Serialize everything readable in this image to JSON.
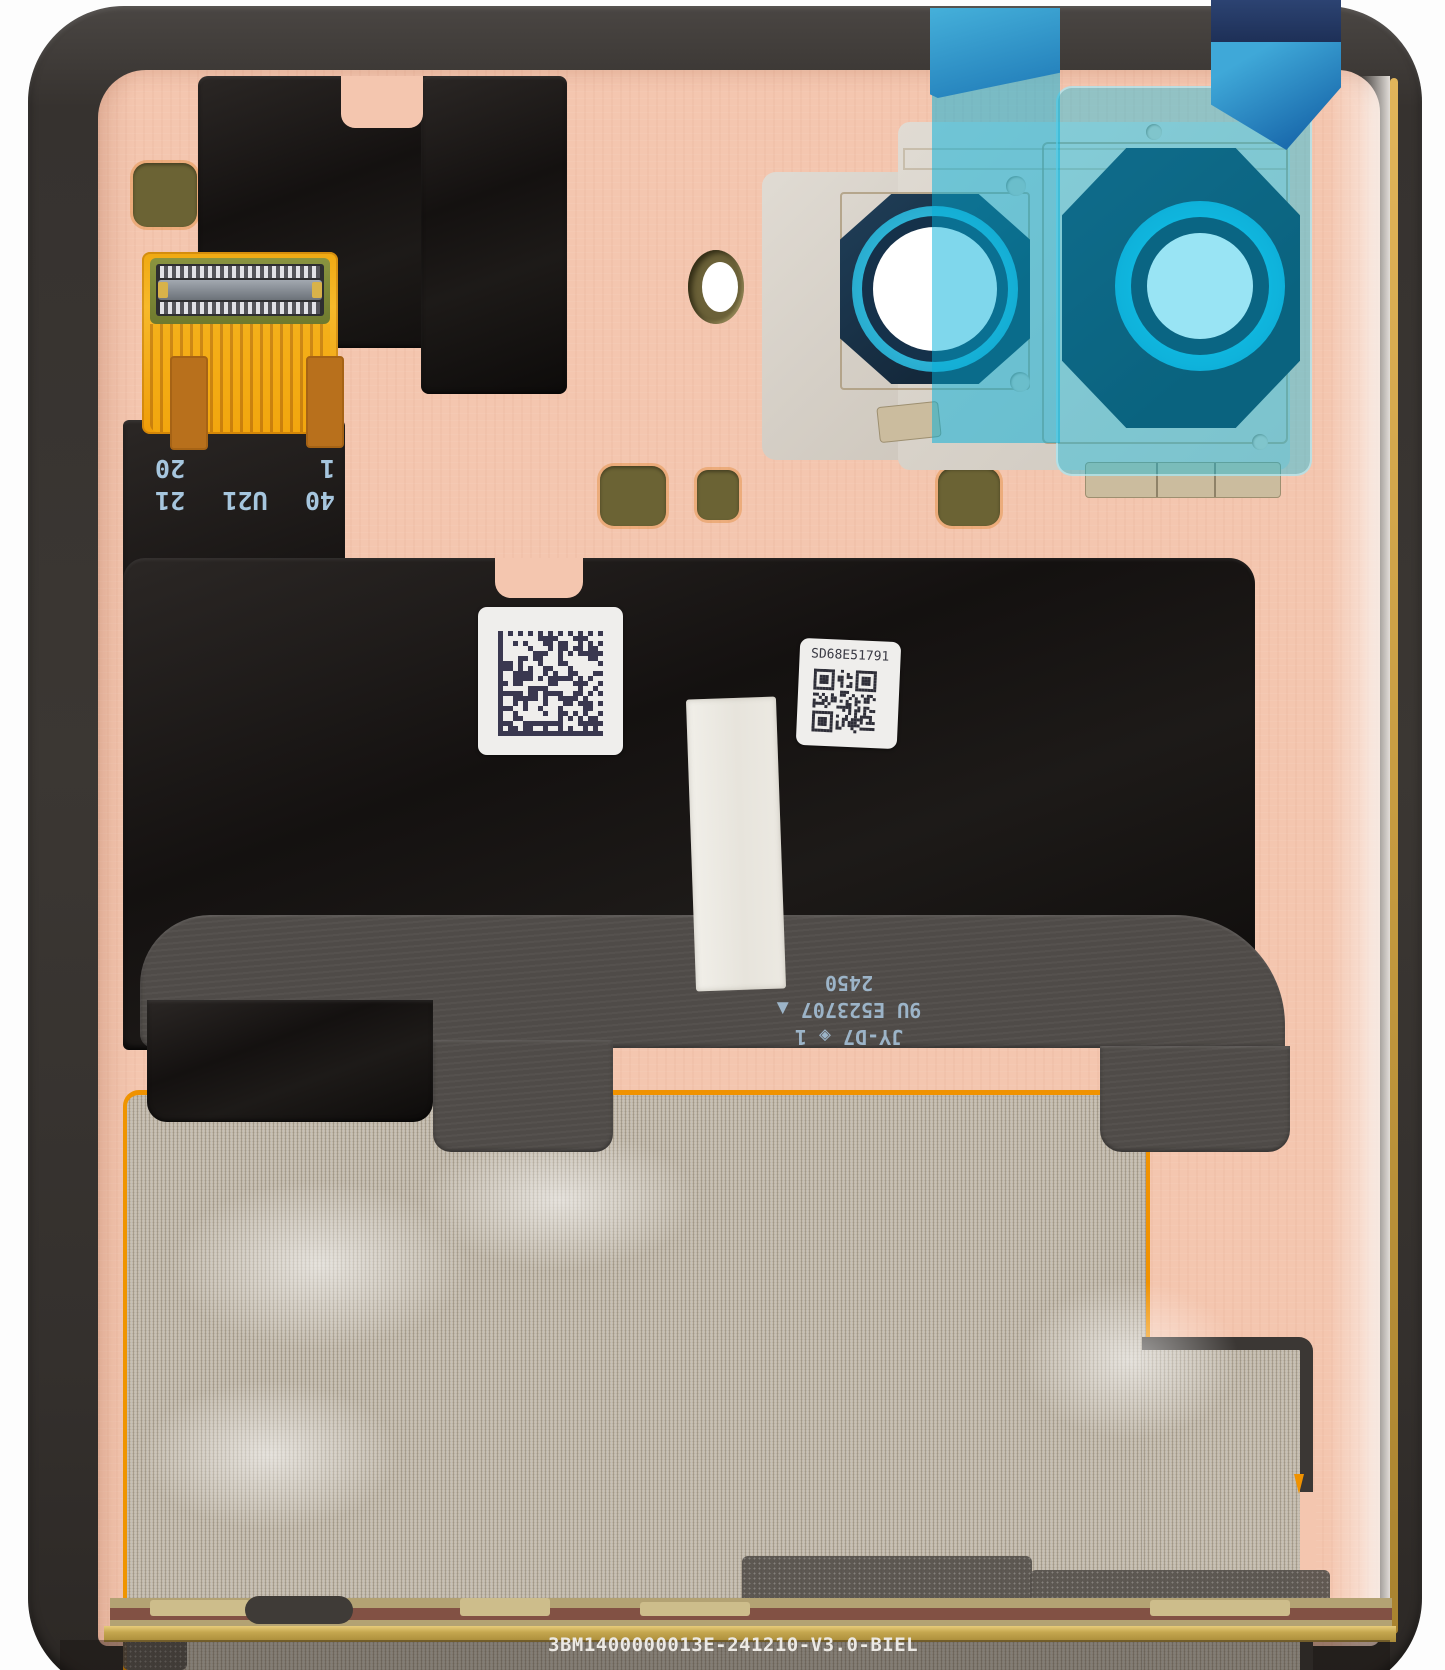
{
  "flex_markings": {
    "connector": {
      "row1_left": "40",
      "row1_center": "U21",
      "row1_right": "21",
      "row2_left": "1",
      "row2_right": "20"
    },
    "cable_line1": "JY-D7 ◈ 1",
    "cable_line2": "9U E523707 ▲",
    "cable_line3": "2450"
  },
  "stickers": {
    "serial": "SD68E51791"
  },
  "bottom_code": "3BM1400000013E-241210-V3.0-BIEL",
  "colors": {
    "cover_pink": "#f4c6af",
    "frame_gray": "#3b3733",
    "film_cyan": "#17bede",
    "tab_blue": "#1e78b6",
    "lens_navy": "#14293c",
    "lens_teal": "#25aed2",
    "flex_gold": "#f2a90f",
    "pad_olive": "#6b6334",
    "mesh_tan": "#c8bfb0",
    "border_orange": "#f09200",
    "marking_blue": "#a6c6de"
  }
}
